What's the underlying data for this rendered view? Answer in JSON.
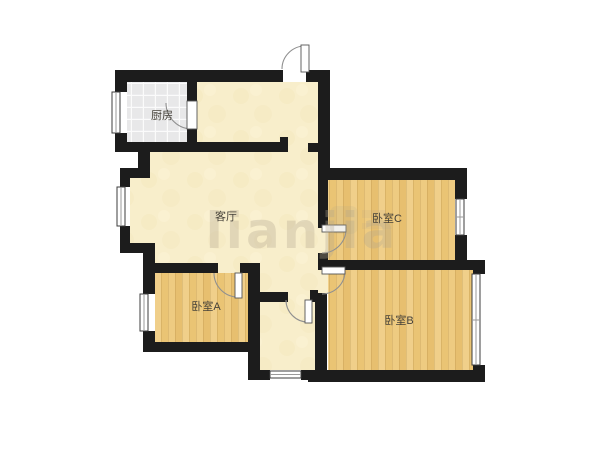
{
  "rooms": {
    "kitchen": {
      "label": "厨房"
    },
    "living_room": {
      "label": "客厅"
    },
    "bedroom_a": {
      "label": "卧室A"
    },
    "bedroom_b": {
      "label": "卧室B"
    },
    "bedroom_c": {
      "label": "卧室C"
    }
  },
  "watermark": {
    "text": "lianjia"
  },
  "colors": {
    "wall": "#1c1c1c",
    "floor_cream": "#f8eecb",
    "cream_mottle": "#eedfae",
    "floor_tile": "#e8e8e9",
    "tile_grid": "#fbfbfb",
    "wood_tone_1": "#eecb81",
    "wood_tone_2": "#e7bf6f",
    "wood_tone_3": "#f0cf8a",
    "wood_tone_4": "#eac474",
    "wood_grain": "rgba(130,90,30,0.22)",
    "label": "#46423a",
    "watermark": "rgba(178,168,142,0.33)"
  }
}
